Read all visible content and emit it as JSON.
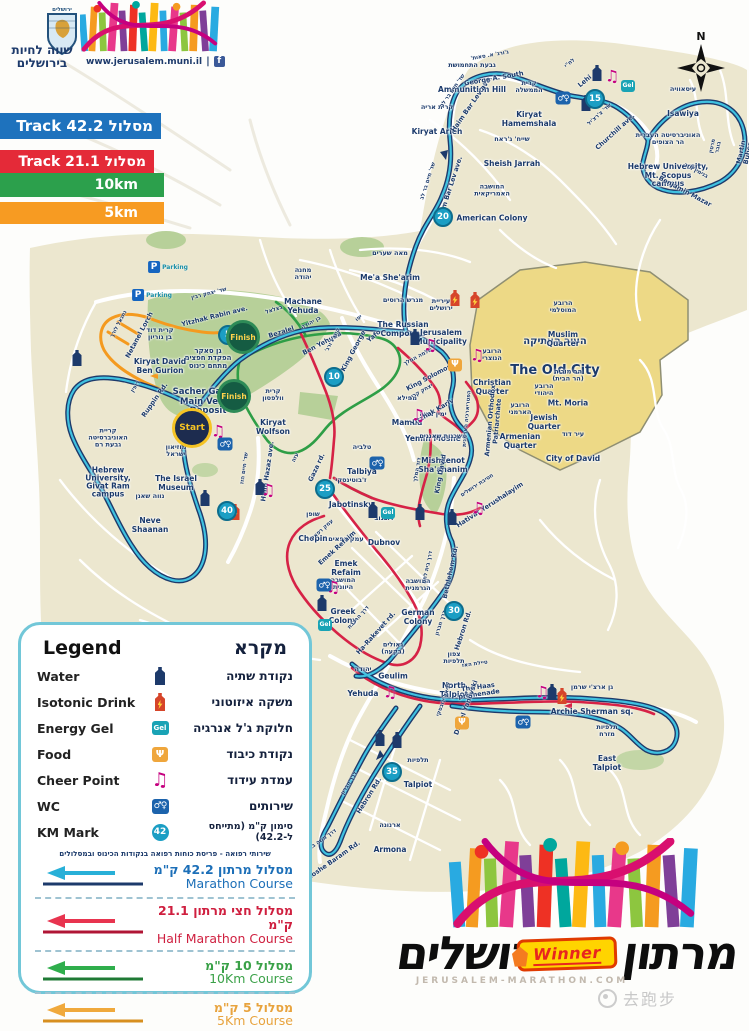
{
  "header": {
    "emblem_text": "ירושלים",
    "tagline": "שווה לחיות\nבירושלים",
    "website": "www.jerusalem.muni.il"
  },
  "track_bars": [
    {
      "label": "Track 42.2 מסלול",
      "color": "#1e72bd"
    },
    {
      "label": "Track 21.1 מסלול",
      "color": "#e42a38"
    },
    {
      "label": "10km",
      "color": "#2ca04c"
    },
    {
      "label": "5km",
      "color": "#f79b22"
    }
  ],
  "compass": {
    "n": "N"
  },
  "map": {
    "labels": [
      {
        "he": "גבעת התחמושת",
        "en": "Ammunition Hill",
        "x": 472,
        "y": 78
      },
      {
        "he": "קרית אריה",
        "en": "Kiryat Arieh",
        "x": 437,
        "y": 120
      },
      {
        "he": "קרית\nהממשלה",
        "en": "Kiryat\nHamemshala",
        "x": 529,
        "y": 104
      },
      {
        "he": "שייח' ג'ראח",
        "en": "Sheish Jarrah",
        "x": 512,
        "y": 152
      },
      {
        "he": "המושבה\nהאמריקאית",
        "en": "American Colony",
        "x": 492,
        "y": 203
      },
      {
        "he": "עיסאוויה",
        "en": "Isawiya",
        "x": 683,
        "y": 102
      },
      {
        "he": "האוניברסיטה העברית\nהר הצופים",
        "en": "Hebrew University,\nMt. Scopus campus",
        "x": 668,
        "y": 160
      },
      {
        "he": "מאה שערים",
        "en": "Me'a She'arim",
        "x": 390,
        "y": 266
      },
      {
        "he": "מחנה\nיהודה",
        "en": "Machane\nYehuda",
        "x": 303,
        "y": 291
      },
      {
        "he": "מגרש הרוסים",
        "en": "The Russian\nCompound",
        "x": 403,
        "y": 317
      },
      {
        "he": "עיריית\nירושלים",
        "en": "Jerusalem\nMunicipality",
        "x": 441,
        "y": 322
      },
      {
        "he": "העיר העתיקה",
        "en": "The Old City",
        "x": 555,
        "y": 357,
        "cls": "big"
      },
      {
        "he": "הרובע\nהמוסלמי",
        "en": "Muslim\nQuarter",
        "x": 563,
        "y": 324
      },
      {
        "he": "הרובע\nהנוצרי",
        "en": "Christian\nQuarter",
        "x": 492,
        "y": 372
      },
      {
        "he": "הרובע\nהיהודי",
        "en": "Jewish\nQuarter",
        "x": 544,
        "y": 407
      },
      {
        "he": "הרובע\nהארמני",
        "en": "Armenian\nQuarter",
        "x": 520,
        "y": 426
      },
      {
        "he": "הר מוריה\n(הר הבית)",
        "en": "Mt. Moria",
        "x": 568,
        "y": 388
      },
      {
        "he": "עיר דוד",
        "en": "City of David",
        "x": 573,
        "y": 447
      },
      {
        "he": "ממילא",
        "en": "Mamila",
        "x": 407,
        "y": 411
      },
      {
        "he": "ימין משה",
        "en": "Yemin Moshe",
        "x": 433,
        "y": 427
      },
      {
        "he": "משכנות שאננים",
        "en": "Mishkenot\nSha'ananim",
        "x": 443,
        "y": 453
      },
      {
        "he": "קרית\nוולפסון",
        "en": "Kiryat\nWolfson",
        "x": 273,
        "y": 412
      },
      {
        "he": "גן סאקר\nהפקדת חפצים\nמתחם כינוס",
        "en": "Sacher Garden\nMain Venue\nDeposit",
        "x": 208,
        "y": 382,
        "cls": "venue"
      },
      {
        "he": "קרית דוד\nבן גוריון",
        "en": "Kiryat David\nBen Gurion",
        "x": 160,
        "y": 351
      },
      {
        "he": "מוזיאון\nישראל",
        "en": "The Israel\nMuseum",
        "x": 176,
        "y": 468
      },
      {
        "he": "קריית\nהאוניברסיטה\nגבעת רם",
        "en": "Hebrew\nUniversity,\nGivat Ram\ncampus",
        "x": 108,
        "y": 463
      },
      {
        "he": "נווה שאנן",
        "en": "Neve\nShaanan",
        "x": 150,
        "y": 513
      },
      {
        "he": "טלביה",
        "en": "Talbiya",
        "x": 362,
        "y": 460
      },
      {
        "he": "ז'בוטינסקי",
        "en": "Jabotinsky",
        "x": 351,
        "y": 493
      },
      {
        "he": "שופן",
        "en": "Chopin",
        "x": 313,
        "y": 527
      },
      {
        "he": "דובנוב",
        "en": "Dubnov",
        "x": 384,
        "y": 531
      },
      {
        "he": "עמק רפאים",
        "en": "Emek\nRefaim",
        "x": 346,
        "y": 556
      },
      {
        "he": "המושבה\nהיוונית",
        "en": "Greek\nColony",
        "x": 343,
        "y": 601
      },
      {
        "he": "המושבה\nהגרמנית",
        "en": "German\nColony",
        "x": 418,
        "y": 602
      },
      {
        "he": "גאולים\n(בקעה)",
        "en": "Geulim",
        "x": 393,
        "y": 661
      },
      {
        "he": "יהודה",
        "en": "Yehuda",
        "x": 363,
        "y": 682
      },
      {
        "he": "צפון\nתלפיות",
        "en": "North\nTalpiot",
        "x": 454,
        "y": 675
      },
      {
        "he": "גן ארצ'י שרמן",
        "en": "Archie Sherman sq.",
        "x": 592,
        "y": 700
      },
      {
        "he": "תלפיות\nמזרח",
        "en": "East\nTalpiot",
        "x": 607,
        "y": 748
      },
      {
        "he": "תלפיות",
        "en": "Talpiot",
        "x": 418,
        "y": 773
      },
      {
        "he": "ארנונה",
        "en": "Armona",
        "x": 390,
        "y": 838
      }
    ],
    "road_labels": [
      {
        "he": "שד' חיים בר לב",
        "en": "Haim Bar Lev ave.",
        "x": 463,
        "y": 98,
        "a": -55
      },
      {
        "he": "שד' חיים בר לב",
        "en": "Haim Bar Lev ave.",
        "x": 440,
        "y": 185,
        "a": -72
      },
      {
        "he": "ג'ורג' א. סאות'",
        "en": "George A. South",
        "x": 492,
        "y": 68,
        "a": -10
      },
      {
        "he": "לח\"י",
        "en": "Lehi",
        "x": 578,
        "y": 73,
        "a": -40
      },
      {
        "he": "שד' צ'רצ'יל",
        "en": "Churchill ave.",
        "x": 608,
        "y": 124,
        "a": -42
      },
      {
        "he": "בנימין מזר",
        "en": "Benjamin Mazar",
        "x": 690,
        "y": 182,
        "a": 28
      },
      {
        "he": "מרטין בובר",
        "en": "Martin Buber",
        "x": 731,
        "y": 150,
        "a": -78
      },
      {
        "he": "שד' יצחק רבין",
        "en": "Yitzhak Rabin ave.",
        "x": 212,
        "y": 306,
        "a": -14
      },
      {
        "he": "נתנאל לורך",
        "en": "Netanel Lorch",
        "x": 130,
        "y": 330,
        "a": -62
      },
      {
        "he": "בצלאל",
        "en": "Bezalel",
        "x": 278,
        "y": 322,
        "a": -18
      },
      {
        "he": "בן יהודה",
        "en": "Ben Yehuda",
        "x": 317,
        "y": 334,
        "a": -28
      },
      {
        "he": "קינג ג'ורג'",
        "en": "King George",
        "x": 344,
        "y": 346,
        "a": -62
      },
      {
        "he": "יפו",
        "en": "Yafo",
        "x": 367,
        "y": 328,
        "a": -40
      },
      {
        "he": "רופין",
        "en": "Ruppin Rd.",
        "x": 146,
        "y": 394,
        "a": -55
      },
      {
        "he": "שד' חיים הזז",
        "en": "Haim Hazaz ave.",
        "x": 257,
        "y": 470,
        "a": -82
      },
      {
        "he": "עזה",
        "en": "Gaza rd.",
        "x": 307,
        "y": 463,
        "a": -65
      },
      {
        "he": "דוד המלך",
        "en": "King David",
        "x": 430,
        "y": 472,
        "a": -80
      },
      {
        "he": "שלמה המלך",
        "en": "King Solomon",
        "x": 424,
        "y": 368,
        "a": -28
      },
      {
        "he": "יצחק קריב",
        "en": "Yitzhak Kariv",
        "x": 427,
        "y": 403,
        "a": -30
      },
      {
        "he": "חטיבת ירושלים",
        "en": "Hativat Yerushalayim",
        "x": 484,
        "y": 496,
        "a": -33
      },
      {
        "he": "הפטריארכיה הארמנית",
        "en": "Armenian Orthodox\nPatriarchate",
        "x": 483,
        "y": 420,
        "a": -85
      },
      {
        "he": "עמק רפאים",
        "en": "Emek Refaim",
        "x": 330,
        "y": 540,
        "a": -42
      },
      {
        "he": "דרך הרכבת",
        "en": "Ha-Rakevet rd.",
        "x": 368,
        "y": 626,
        "a": -48
      },
      {
        "he": "דרך בית לחם",
        "en": "Bethlehem Rd.",
        "x": 440,
        "y": 570,
        "a": -78
      },
      {
        "he": "דרך חברון",
        "en": "Hebron Rd.",
        "x": 453,
        "y": 627,
        "a": -72
      },
      {
        "he": "דרך חברון",
        "en": "Hebron Rd.",
        "x": 360,
        "y": 790,
        "a": -58
      },
      {
        "he": "דרך משה ברעם",
        "en": "Moshe Baram Rd.",
        "x": 327,
        "y": 852,
        "a": -35
      },
      {
        "he": "טיילת האז",
        "en": "The Haas\npromenade",
        "x": 477,
        "y": 680,
        "a": -8
      },
      {
        "he": "דניאל ינובסקי",
        "en": "Daniel Yanovski",
        "x": 456,
        "y": 704,
        "a": -70
      }
    ],
    "km_markers": [
      {
        "n": "5",
        "x": 228,
        "y": 335
      },
      {
        "n": "10",
        "x": 334,
        "y": 377
      },
      {
        "n": "15",
        "x": 595,
        "y": 99
      },
      {
        "n": "20",
        "x": 443,
        "y": 217
      },
      {
        "n": "25",
        "x": 325,
        "y": 489
      },
      {
        "n": "30",
        "x": 454,
        "y": 611
      },
      {
        "n": "35",
        "x": 392,
        "y": 772
      },
      {
        "n": "40",
        "x": 227,
        "y": 511
      }
    ],
    "points": [
      {
        "t": "water",
        "x": 597,
        "y": 73
      },
      {
        "t": "water",
        "x": 586,
        "y": 103
      },
      {
        "t": "water",
        "x": 415,
        "y": 337
      },
      {
        "t": "water",
        "x": 205,
        "y": 498
      },
      {
        "t": "water",
        "x": 77,
        "y": 358
      },
      {
        "t": "water",
        "x": 260,
        "y": 487
      },
      {
        "t": "water",
        "x": 373,
        "y": 510
      },
      {
        "t": "water",
        "x": 420,
        "y": 512
      },
      {
        "t": "water",
        "x": 452,
        "y": 517
      },
      {
        "t": "water",
        "x": 322,
        "y": 603
      },
      {
        "t": "water",
        "x": 380,
        "y": 738
      },
      {
        "t": "water",
        "x": 397,
        "y": 740
      },
      {
        "t": "water",
        "x": 552,
        "y": 692
      },
      {
        "t": "isotonic",
        "x": 455,
        "y": 298
      },
      {
        "t": "isotonic",
        "x": 475,
        "y": 300
      },
      {
        "t": "isotonic",
        "x": 562,
        "y": 696
      },
      {
        "t": "isotonic",
        "x": 235,
        "y": 512
      },
      {
        "t": "gel",
        "x": 628,
        "y": 86
      },
      {
        "t": "gel",
        "x": 388,
        "y": 513
      },
      {
        "t": "gel",
        "x": 325,
        "y": 625
      },
      {
        "t": "food",
        "x": 455,
        "y": 365
      },
      {
        "t": "food",
        "x": 462,
        "y": 723
      },
      {
        "t": "cheer",
        "x": 612,
        "y": 76
      },
      {
        "t": "cheer",
        "x": 430,
        "y": 345
      },
      {
        "t": "cheer",
        "x": 477,
        "y": 355
      },
      {
        "t": "cheer",
        "x": 218,
        "y": 431
      },
      {
        "t": "cheer",
        "x": 268,
        "y": 490
      },
      {
        "t": "cheer",
        "x": 333,
        "y": 587
      },
      {
        "t": "cheer",
        "x": 478,
        "y": 508
      },
      {
        "t": "cheer",
        "x": 542,
        "y": 692
      },
      {
        "t": "cheer",
        "x": 390,
        "y": 692
      },
      {
        "t": "cheer",
        "x": 418,
        "y": 415
      },
      {
        "t": "wc",
        "x": 563,
        "y": 98
      },
      {
        "t": "wc",
        "x": 225,
        "y": 444
      },
      {
        "t": "wc",
        "x": 324,
        "y": 585
      },
      {
        "t": "wc",
        "x": 523,
        "y": 722
      },
      {
        "t": "wc",
        "x": 377,
        "y": 463
      },
      {
        "t": "parking",
        "x": 168,
        "y": 267,
        "label": "Parking"
      },
      {
        "t": "parking",
        "x": 152,
        "y": 295,
        "label": "Parking"
      }
    ],
    "start_finish": [
      {
        "type": "start",
        "label": "Start",
        "x": 192,
        "y": 428
      },
      {
        "type": "finish",
        "label": "Finish",
        "x": 243,
        "y": 337
      },
      {
        "type": "finish",
        "label": "Finish",
        "x": 234,
        "y": 396
      }
    ]
  },
  "legend": {
    "title_en": "Legend",
    "title_he": "מקרא",
    "items": [
      {
        "icon": "water",
        "en": "Water",
        "he": "נקודת שתיה"
      },
      {
        "icon": "isotonic",
        "en": "Isotonic Drink",
        "he": "משקה איזוטוני"
      },
      {
        "icon": "gel",
        "en": "Energy Gel",
        "he": "חלוקת ג'ל אנרגיה"
      },
      {
        "icon": "food",
        "en": "Food",
        "he": "נקודת כיבוד"
      },
      {
        "icon": "cheer",
        "en": "Cheer Point",
        "he": "עמדת עידוד"
      },
      {
        "icon": "wc",
        "en": "WC",
        "he": "שירותים"
      },
      {
        "icon": "km",
        "en": "KM Mark",
        "he": "סימון ק\"מ (מתייחס ל-42.2)",
        "km": "42"
      }
    ],
    "note": "שירותי רפואה - פריסת כוחות רפואה בנקודות הכינוס ובמסלולים",
    "courses": [
      {
        "he": "מסלול מרתון 42.2 ק\"מ",
        "en": "Marathon Course",
        "color": "#1c6fb8",
        "arrow": "#28b0d8",
        "line": "#1d3a6b"
      },
      {
        "he": "מסלול חצי מרתון 21.1 ק\"מ",
        "en": "Half Marathon Course",
        "color": "#cf1f3f",
        "arrow": "#e8344f",
        "line": "#b01535"
      },
      {
        "he": "מסלול 10 ק\"מ",
        "en": "10Km Course",
        "color": "#3aa148",
        "arrow": "#2fae4c",
        "line": "#1f7a35"
      },
      {
        "he": "מסלול 5 ק\"מ",
        "en": "5Km Course",
        "color": "#e8a33d",
        "arrow": "#f0a93c",
        "line": "#d78f1f"
      }
    ]
  },
  "footer": {
    "word_left": "ירושלים",
    "winner": "Winner",
    "word_right": "מרתון",
    "site": "JERUSALEM-MARATHON.COM"
  },
  "watermark": {
    "text": "去跑步"
  }
}
